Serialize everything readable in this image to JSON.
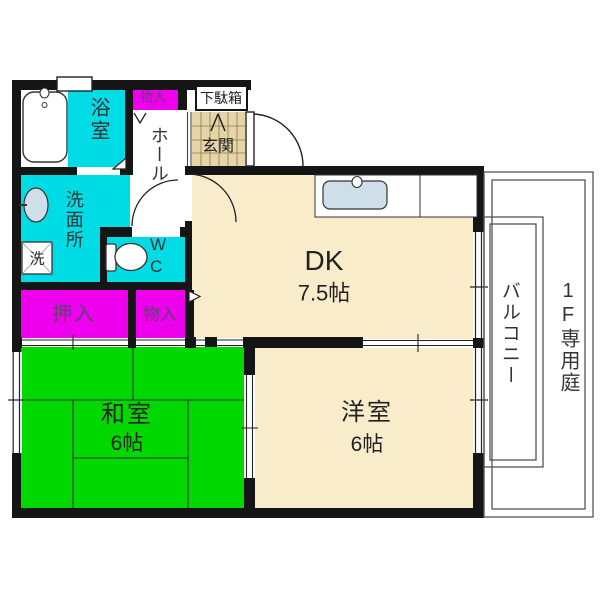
{
  "plan": {
    "rooms": {
      "bath": {
        "label": "浴室"
      },
      "storage_top": {
        "label": "物入"
      },
      "shoe_cabinet": {
        "label": "下駄箱"
      },
      "entrance": {
        "label": "玄関"
      },
      "hall": {
        "label": "ホール"
      },
      "washroom": {
        "label": "洗面所"
      },
      "washer": {
        "label": "洗"
      },
      "wc": {
        "label": "W\nC"
      },
      "closet": {
        "label": "押入"
      },
      "storage": {
        "label": "物入"
      },
      "dk": {
        "label": "DK",
        "size": "7.5帖"
      },
      "japanese_room": {
        "label": "和室",
        "size": "6帖"
      },
      "western_room": {
        "label": "洋室",
        "size": "6帖"
      },
      "balcony": {
        "label": "バルコニー"
      },
      "garden": {
        "label": "1F専用庭"
      }
    },
    "colors": {
      "wall": "#151515",
      "cyan": "#00dce6",
      "magenta": "#ee00ee",
      "green": "#00d800",
      "beige": "#f8ecca",
      "tile": "#e6d5a6",
      "sink_blue": "#cfdfe9",
      "fence_line": "#555555",
      "label_text": "#333333",
      "closet_text": "#5a4668"
    }
  }
}
